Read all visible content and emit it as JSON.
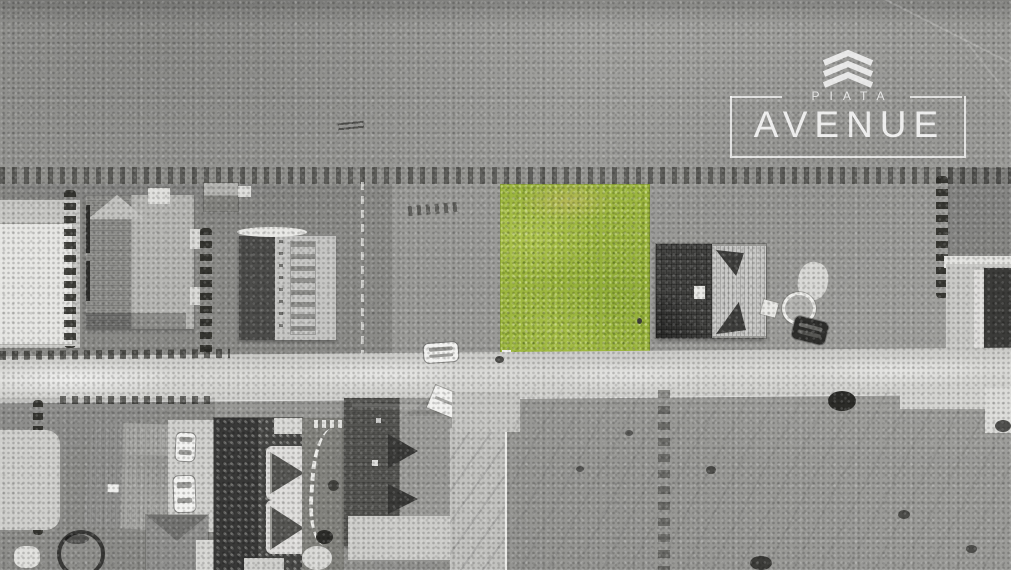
{
  "watermark": {
    "brand_top": "PIATA",
    "brand_main": "AVENUE",
    "logo_icon": "triple-chevron-icon",
    "text_color": "#f5f5f2"
  },
  "scene": {
    "type": "aerial-drone-photo",
    "style": "grayscale-photo-with-single-color-highlight",
    "highlight_plot_color": "#a3bd42",
    "road_color": "#d8d8d5",
    "field_color": "#9b9b98",
    "dark_roof_color": "#3e3e3c",
    "light_roof_color": "#c6c6c4"
  }
}
